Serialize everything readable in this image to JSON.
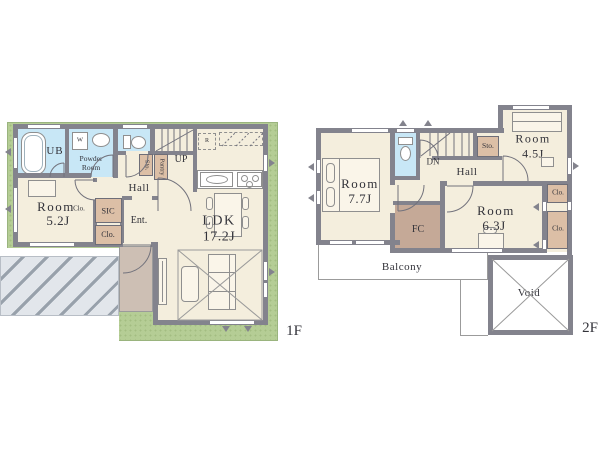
{
  "colors": {
    "lawn_green": "#b5cd95",
    "wall_gray": "#83838d",
    "floor_cream": "#f4eedd",
    "water_blue": "#c8e7f6",
    "closet_tan": "#dcbfa6",
    "porch_brown": "#cdbfb4",
    "fc_brown": "#c5a997",
    "driveway_gray": "#e2e6eb"
  },
  "f1": {
    "floor_label": "1F",
    "ub": "UB",
    "washer": "W",
    "powder_room": "Powder Room",
    "hall": "Hall",
    "up": "UP",
    "fridge": "R",
    "sto": "Sto.",
    "pantry": "Pantry",
    "sic": "SIC",
    "closet": "Clo.",
    "room_closet": "Clo.",
    "ent": "Ent.",
    "bedroom": {
      "name": "Room",
      "size": "5.2J"
    },
    "ldk": {
      "name": "LDK",
      "size": "17.2J"
    }
  },
  "f2": {
    "floor_label": "2F",
    "dn": "DN",
    "hall": "Hall",
    "sto": "Sto.",
    "fc": "FC",
    "balcony": "Balcony",
    "void": "Void",
    "closet_upper": "Clo.",
    "closet_lower": "Clo.",
    "bedroom1": {
      "name": "Room",
      "size": "7.7J"
    },
    "bedroom2": {
      "name": "Room",
      "size": "4.5J"
    },
    "bedroom3": {
      "name": "Room",
      "size": "6.3J"
    }
  }
}
